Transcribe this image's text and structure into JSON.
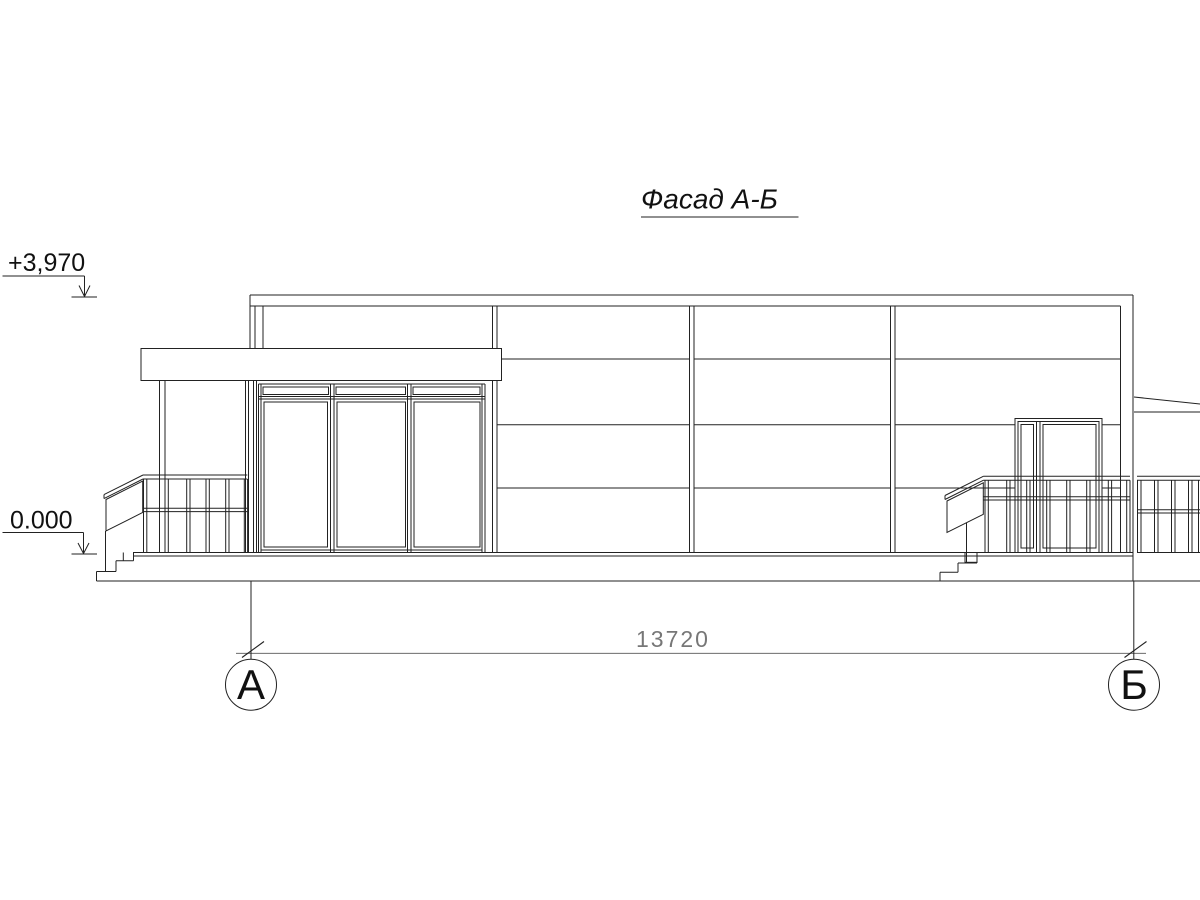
{
  "drawing_title": {
    "label": "Фасад А-Б"
  },
  "elevation_marks": {
    "top": "+3,970",
    "base": "0.000"
  },
  "dimension": {
    "total": "13720"
  },
  "axes": {
    "left": "А",
    "right": "Б"
  },
  "colors": {
    "background": "#ffffff",
    "line": "#222222",
    "dimension_line": "#555555",
    "dimension_text": "#777777"
  }
}
